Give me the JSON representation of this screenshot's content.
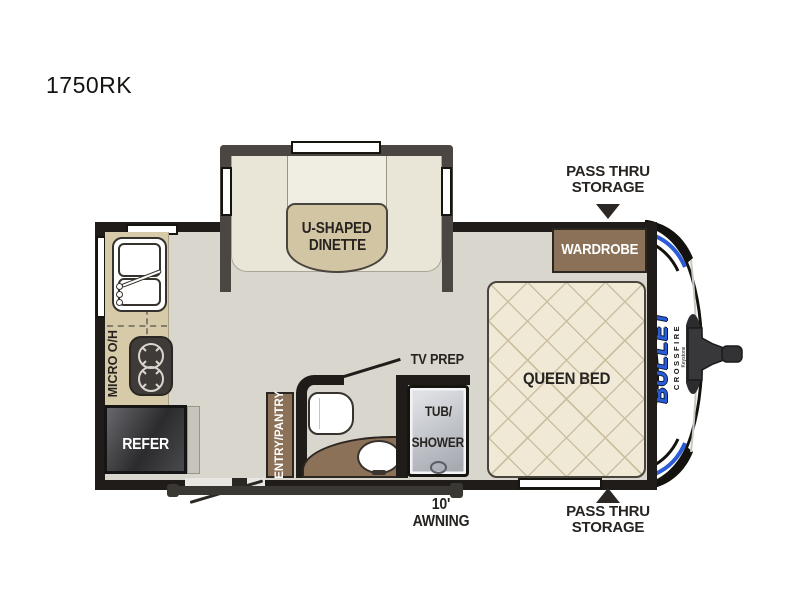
{
  "plan": {
    "model": "1750RK",
    "labels": {
      "dinette_line1": "U-SHAPED",
      "dinette_line2": "DINETTE",
      "wardrobe": "WARDROBE",
      "queen_bed": "QUEEN BED",
      "micro_overhead": "MICRO O/H",
      "refer": "REFER",
      "entry_pantry": "ENTRY/PANTRY",
      "tv_prep": "TV PREP",
      "tub_line1": "TUB/",
      "tub_line2": "SHOWER",
      "awning": "10' AWNING",
      "pass_thru_line1": "PASS THRU",
      "pass_thru_line2": "STORAGE"
    },
    "logo": {
      "brand": "BULLET",
      "series": "CROSSFIRE",
      "maker": "Keystone"
    },
    "colors": {
      "floor": "#d9d6cd",
      "wall": "#1f1c19",
      "slide_wall": "#4c4642",
      "cushion": "#e9e5d7",
      "table_tan": "#d2c5a3",
      "counter_tan": "#d7caa9",
      "bed_cream": "#efe9d6",
      "bed_lattice": "#ccc0a2",
      "cabinet_brown": "#8b7157",
      "appliance_dark": "#3f3b38",
      "tub_gray": "#b9bdc4",
      "logo_blue": "#2b5cd8"
    }
  }
}
